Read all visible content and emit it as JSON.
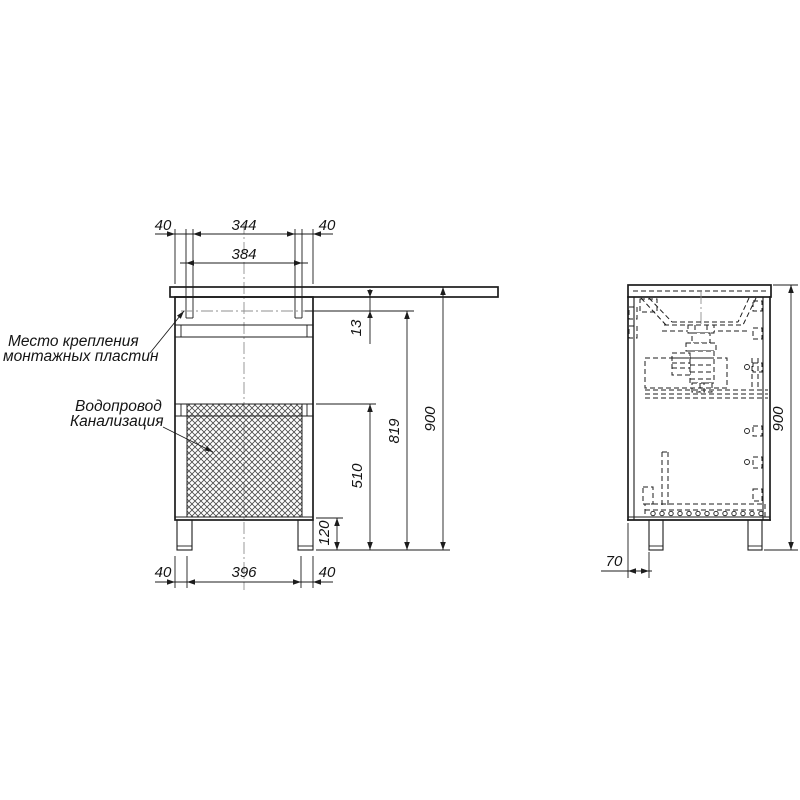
{
  "front_view": {
    "labels": {
      "mounting_plates_line1": "Место крепления",
      "mounting_plates_line2": "монтажных пластин",
      "plumbing_line1": "Водопровод",
      "plumbing_line2": "Канализация"
    },
    "dimensions": {
      "top_left_offset": "40",
      "plate_spacing": "344",
      "top_right_offset": "40",
      "plate_span": "384",
      "countertop_to_plate": "13",
      "plate_to_floor": "819",
      "total_height": "900",
      "cutout_to_floor": "510",
      "leg_height": "120",
      "bottom_left_offset": "40",
      "leg_spacing": "396",
      "bottom_right_offset": "40"
    }
  },
  "side_view": {
    "dimensions": {
      "total_height": "900",
      "leg_front_inset": "70"
    }
  },
  "colors": {
    "line": "#1c1c1c",
    "centerline": "#8f8f8f",
    "background": "#ffffff"
  }
}
